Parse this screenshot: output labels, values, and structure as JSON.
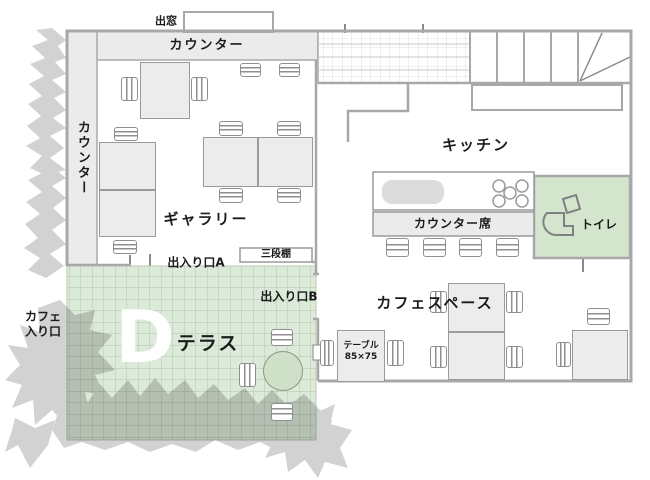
{
  "title": "cafe-floor-plan",
  "colors": {
    "wall_stroke": "#a8a8a8",
    "band_fill": "#ebebeb",
    "terrace_green": "#dceada",
    "terrace_grid": "#aec5a8",
    "toilet_green": "#d4e5ce",
    "tree_gray": "#d2d2d2",
    "table_fill": "#ececec",
    "letter_white": "#ffffff"
  },
  "labels": [
    {
      "id": "bay-window",
      "text": "出窓",
      "x": 166,
      "y": 21,
      "size": 11
    },
    {
      "id": "counter-top",
      "text": "カウンター",
      "x": 207,
      "y": 46,
      "size": 13,
      "spacing": 2
    },
    {
      "id": "counter-left",
      "text": "カウンター",
      "x": 82,
      "y": 158,
      "size": 13,
      "vertical": true
    },
    {
      "id": "gallery",
      "text": "ギャラリー",
      "x": 206,
      "y": 219,
      "size": 15,
      "spacing": 2
    },
    {
      "id": "kitchen",
      "text": "キッチン",
      "x": 476,
      "y": 145,
      "size": 15,
      "spacing": 2
    },
    {
      "id": "counter-seats",
      "text": "カウンター席",
      "x": 453,
      "y": 224,
      "size": 12,
      "spacing": 1
    },
    {
      "id": "toilet",
      "text": "トイレ",
      "x": 599,
      "y": 225,
      "size": 12
    },
    {
      "id": "three-tier-shelf",
      "text": "三段棚",
      "x": 276,
      "y": 255,
      "size": 10
    },
    {
      "id": "entrance-a",
      "text": "出入り口A",
      "x": 196,
      "y": 263,
      "size": 12
    },
    {
      "id": "entrance-b",
      "text": "出入り口B",
      "x": 289,
      "y": 297,
      "size": 12
    },
    {
      "id": "cafe-space",
      "text": "カフェスペース",
      "x": 435,
      "y": 303,
      "size": 15,
      "spacing": 2
    },
    {
      "id": "cafe-entrance",
      "text": "カフェ\n入り口",
      "x": 43,
      "y": 324,
      "size": 12
    },
    {
      "id": "terrace",
      "text": "テラス",
      "x": 208,
      "y": 344,
      "size": 19,
      "spacing": 2
    },
    {
      "id": "terrace-letter-d",
      "text": "D",
      "x": 145,
      "y": 338,
      "size": 72,
      "color": "#ffffff"
    },
    {
      "id": "table-size",
      "text": "テーブル\n85×75",
      "x": 361,
      "y": 352,
      "size": 9
    }
  ],
  "furniture": {
    "tables": [
      {
        "x": 140,
        "y": 62,
        "w": 50,
        "h": 57
      },
      {
        "x": 99,
        "y": 142,
        "w": 57,
        "h": 48
      },
      {
        "x": 99,
        "y": 190,
        "w": 57,
        "h": 47
      },
      {
        "x": 203,
        "y": 137,
        "w": 55,
        "h": 50
      },
      {
        "x": 258,
        "y": 137,
        "w": 55,
        "h": 50
      },
      {
        "x": 448,
        "y": 283,
        "w": 57,
        "h": 49
      },
      {
        "x": 448,
        "y": 332,
        "w": 57,
        "h": 48
      },
      {
        "x": 337,
        "y": 330,
        "w": 48,
        "h": 52
      },
      {
        "x": 572,
        "y": 330,
        "w": 56,
        "h": 50
      }
    ],
    "chairs": [
      {
        "x": 121,
        "y": 77,
        "w": 17,
        "h": 24,
        "dir": "v"
      },
      {
        "x": 191,
        "y": 77,
        "w": 17,
        "h": 24,
        "dir": "v"
      },
      {
        "x": 240,
        "y": 63,
        "w": 21,
        "h": 14,
        "dir": "h"
      },
      {
        "x": 279,
        "y": 63,
        "w": 21,
        "h": 14,
        "dir": "h"
      },
      {
        "x": 114,
        "y": 127,
        "w": 24,
        "h": 14,
        "dir": "h"
      },
      {
        "x": 113,
        "y": 240,
        "w": 24,
        "h": 14,
        "dir": "h"
      },
      {
        "x": 219,
        "y": 121,
        "w": 24,
        "h": 15,
        "dir": "h"
      },
      {
        "x": 277,
        "y": 121,
        "w": 24,
        "h": 15,
        "dir": "h"
      },
      {
        "x": 219,
        "y": 188,
        "w": 24,
        "h": 15,
        "dir": "h"
      },
      {
        "x": 277,
        "y": 188,
        "w": 24,
        "h": 15,
        "dir": "h"
      },
      {
        "x": 386,
        "y": 238,
        "w": 23,
        "h": 19,
        "dir": "h"
      },
      {
        "x": 423,
        "y": 238,
        "w": 23,
        "h": 19,
        "dir": "h"
      },
      {
        "x": 459,
        "y": 238,
        "w": 23,
        "h": 19,
        "dir": "h"
      },
      {
        "x": 496,
        "y": 238,
        "w": 23,
        "h": 19,
        "dir": "h"
      },
      {
        "x": 430,
        "y": 291,
        "w": 17,
        "h": 22,
        "dir": "v"
      },
      {
        "x": 506,
        "y": 291,
        "w": 17,
        "h": 22,
        "dir": "v"
      },
      {
        "x": 430,
        "y": 346,
        "w": 17,
        "h": 22,
        "dir": "v"
      },
      {
        "x": 506,
        "y": 346,
        "w": 17,
        "h": 22,
        "dir": "v"
      },
      {
        "x": 320,
        "y": 340,
        "w": 14,
        "h": 26,
        "dir": "v"
      },
      {
        "x": 387,
        "y": 340,
        "w": 17,
        "h": 26,
        "dir": "v"
      },
      {
        "x": 587,
        "y": 308,
        "w": 23,
        "h": 17,
        "dir": "h"
      },
      {
        "x": 556,
        "y": 342,
        "w": 15,
        "h": 25,
        "dir": "v"
      },
      {
        "x": 271,
        "y": 329,
        "w": 22,
        "h": 17,
        "dir": "h"
      },
      {
        "x": 239,
        "y": 363,
        "w": 17,
        "h": 24,
        "dir": "v"
      },
      {
        "x": 271,
        "y": 403,
        "w": 22,
        "h": 18,
        "dir": "h"
      }
    ],
    "round_table": {
      "x": 263,
      "y": 351,
      "w": 40,
      "h": 40
    }
  }
}
